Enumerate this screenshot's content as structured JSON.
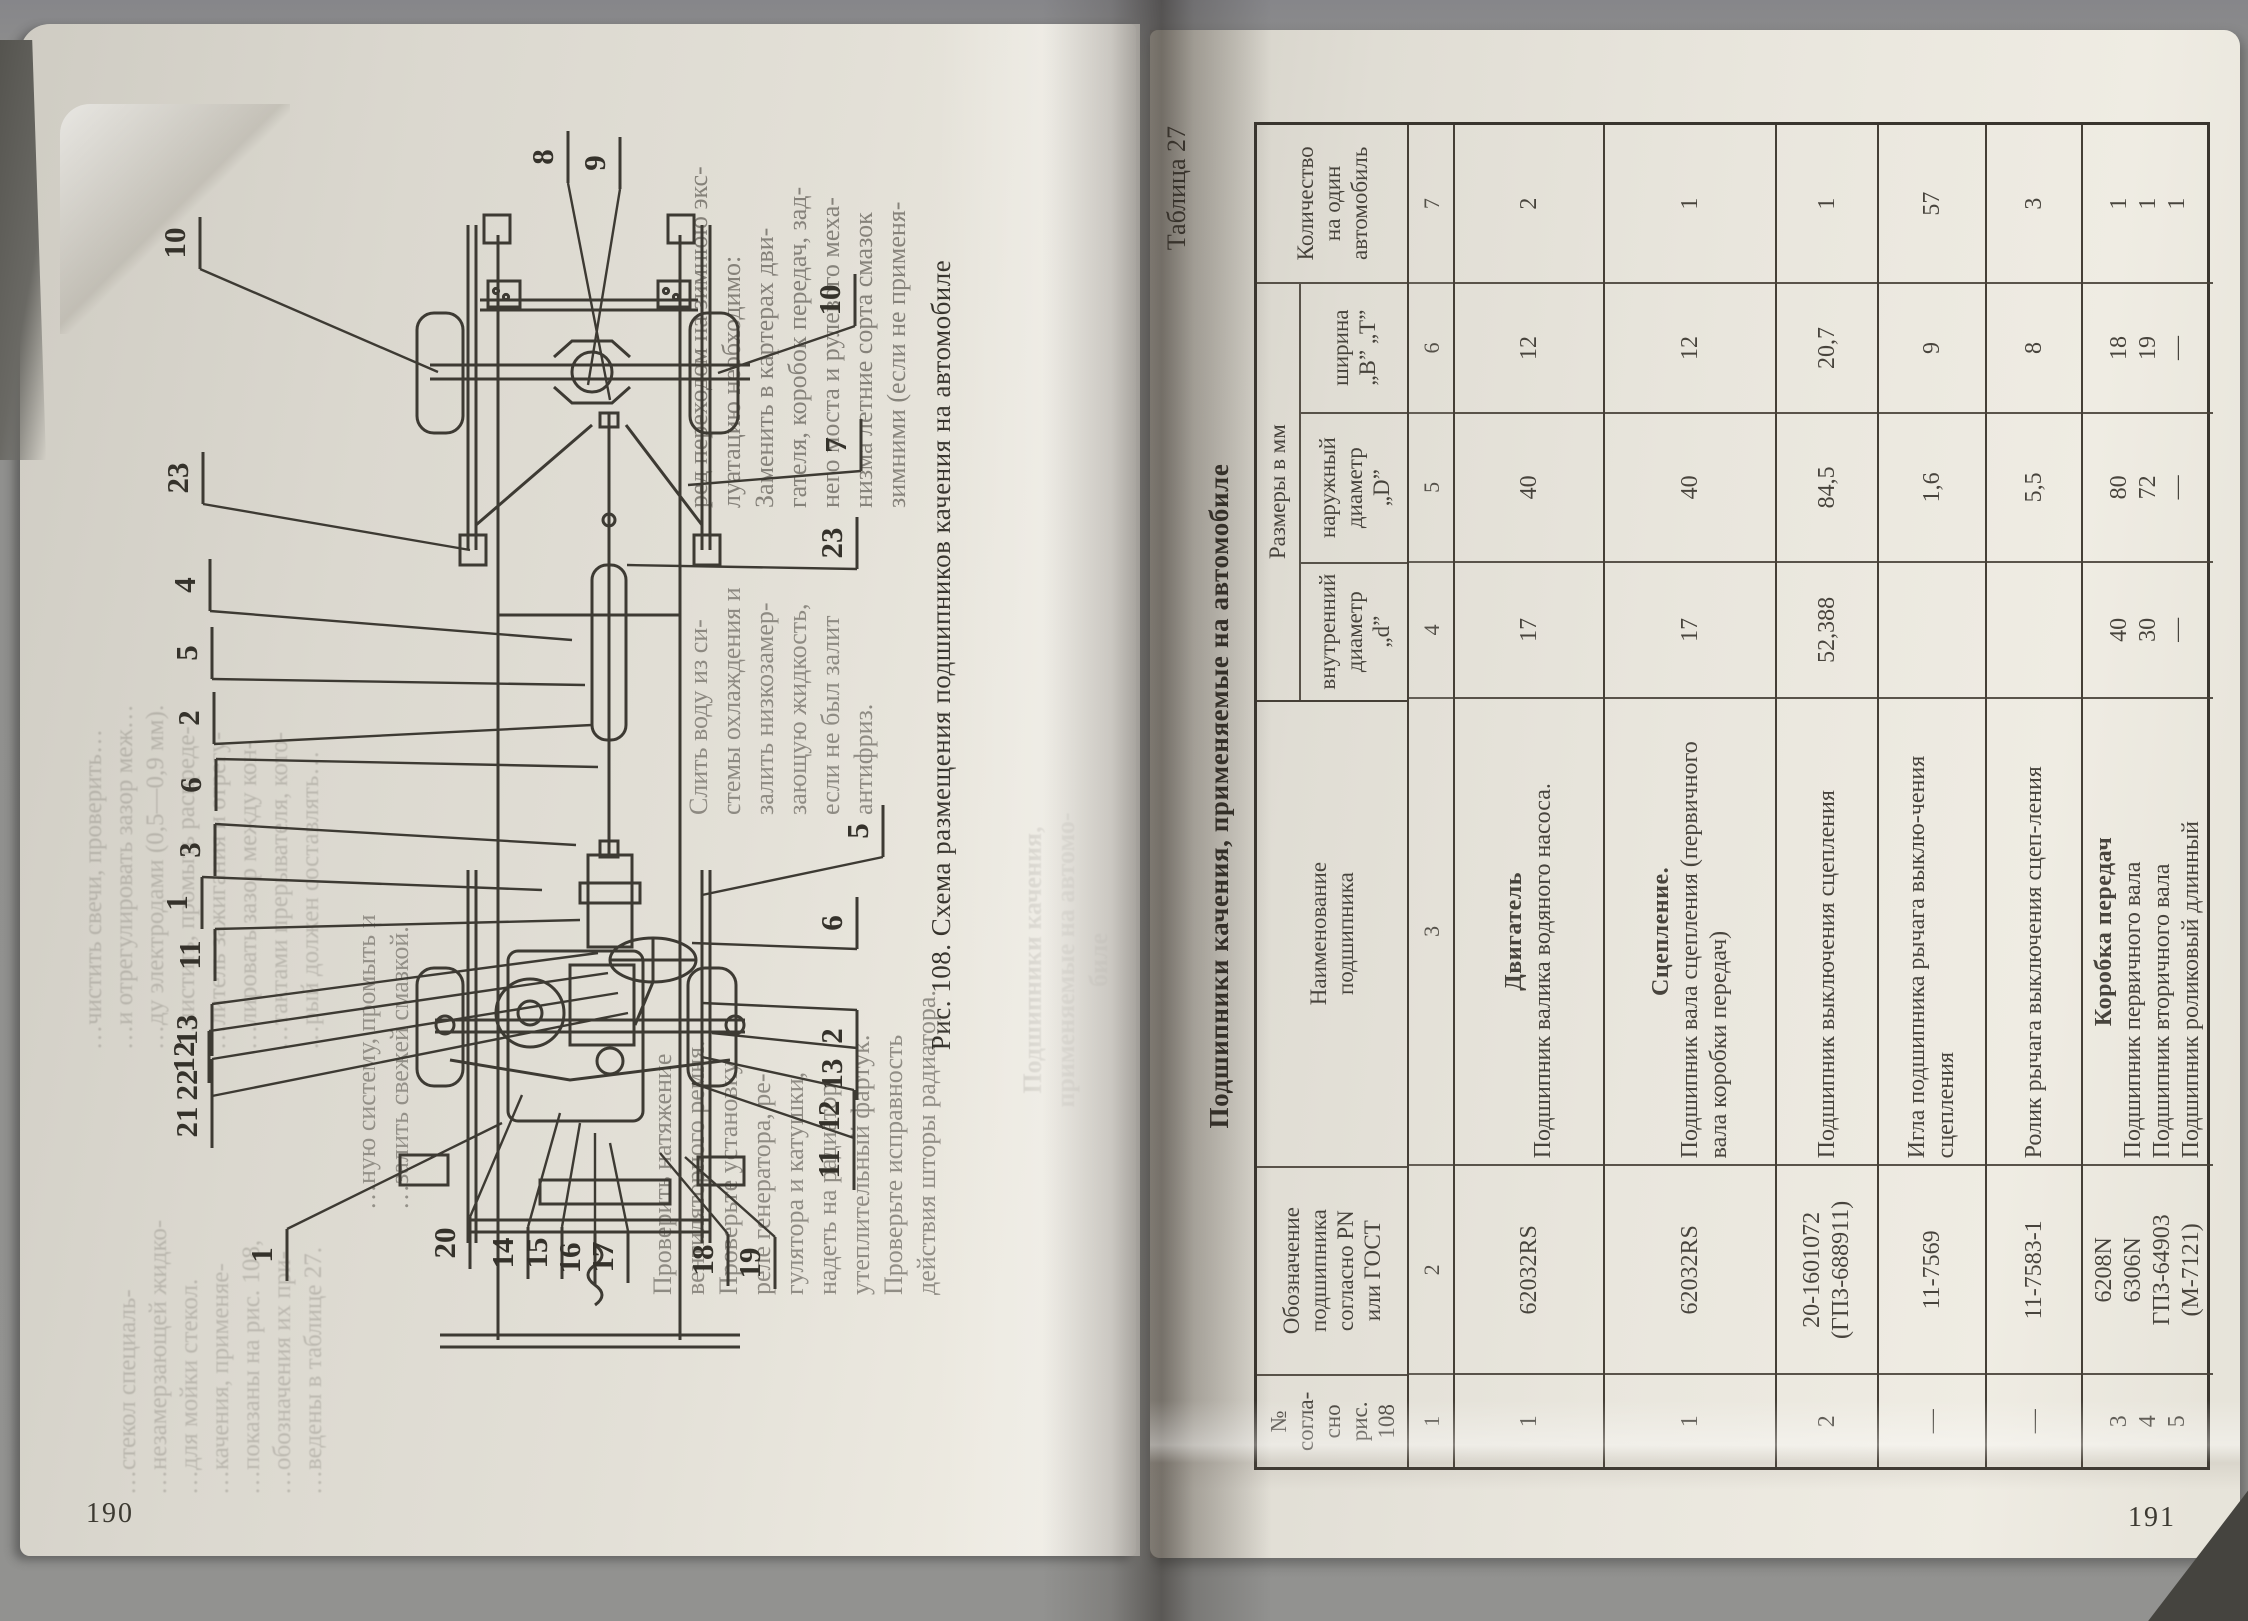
{
  "left_page": {
    "page_number": "190",
    "figure_caption": "Рис. 108. Схема размещения подшипников качения на автомобиле",
    "ghost_top_lines": [
      "…чистить свечи, проверить…",
      "…и отрегулировать зазор меж…",
      "…ду электродами (0,5—0,9 мм).",
      "…чистить, промыть распреде-",
      "…литель зажигания и отрегу-",
      "…лировать зазор между кон-",
      "…тактами прерывателя, кото-",
      "…рый должен составлять…"
    ],
    "ghost_left_lines": [
      "…стекол специаль-",
      "…незамерзающей жидко-",
      "…для мойки стекол.",
      "…качения, применяе-",
      "…показаны на рис. 108,",
      "…обозначения их при-",
      "…ведены в таблице 27."
    ],
    "col_right_lines": [
      "ред переходом на зимнюю экс-",
      "луатацию необходимо:",
      "Заменить в картерах дви-",
      "гателя, коробок передач, зад-",
      "него моста и рулевого меха-",
      "низма летние сорта смазок",
      "зимними (если не применя-"
    ],
    "col_left_lines": [
      "Слить воду из си-",
      "стемы охлаждения и",
      "залить низкозамер-",
      "зающую жидкость,",
      "если не был залит",
      "антифриз."
    ],
    "block_b_lines": [
      "…ную систему, промыть и",
      "…залить свежей смазкой."
    ],
    "block_c_lines": [
      "Проверить натяжение",
      "вентиляторного ремня.",
      "Проверьте установку",
      "реле генератора, ре-",
      "гулятора и катушки,",
      "надеть на радиатор",
      "утеплительный фартук.",
      "Проверьте исправность",
      "действия шторы радиатора."
    ],
    "heading_ghost_lines": [
      "Подшипники качения,",
      "применяемые на автомо-",
      "биле"
    ],
    "callouts": [
      {
        "n": "8",
        "x": 413,
        "y": 62,
        "tx": 470,
        "ty": 305
      },
      {
        "n": "9",
        "x": 465,
        "y": 68,
        "tx": 448,
        "ty": 290
      },
      {
        "n": "10",
        "x": 45,
        "y": 148,
        "tx": 298,
        "ty": 277
      },
      {
        "n": "10",
        "x": 700,
        "y": 205,
        "tx": 578,
        "ty": 278
      },
      {
        "n": "7",
        "x": 706,
        "y": 350,
        "tx": 548,
        "ty": 390
      },
      {
        "n": "23",
        "x": 702,
        "y": 448,
        "tx": 487,
        "ty": 470
      },
      {
        "n": "23",
        "x": 48,
        "y": 383,
        "tx": 330,
        "ty": 455
      },
      {
        "n": "4",
        "x": 55,
        "y": 490,
        "tx": 432,
        "ty": 545
      },
      {
        "n": "5",
        "x": 57,
        "y": 558,
        "tx": 445,
        "ty": 590
      },
      {
        "n": "2",
        "x": 59,
        "y": 623,
        "tx": 452,
        "ty": 630
      },
      {
        "n": "6",
        "x": 61,
        "y": 690,
        "tx": 458,
        "ty": 672
      },
      {
        "n": "3",
        "x": 60,
        "y": 755,
        "tx": 436,
        "ty": 750
      },
      {
        "n": "1",
        "x": 47,
        "y": 808,
        "tx": 402,
        "ty": 795
      },
      {
        "n": "11",
        "x": 60,
        "y": 860,
        "tx": 440,
        "ty": 825
      },
      {
        "n": "13",
        "x": 57,
        "y": 935,
        "tx": 458,
        "ty": 858
      },
      {
        "n": "12",
        "x": 54,
        "y": 962,
        "tx": 468,
        "ty": 878
      },
      {
        "n": "22",
        "x": 57,
        "y": 990,
        "tx": 478,
        "ty": 898
      },
      {
        "n": "21",
        "x": 57,
        "y": 1027,
        "tx": 488,
        "ty": 918
      },
      {
        "n": "1",
        "x": 132,
        "y": 1160,
        "tx": 362,
        "ty": 1028
      },
      {
        "n": "20",
        "x": 315,
        "y": 1148,
        "tx": 382,
        "ty": 1000
      },
      {
        "n": "14",
        "x": 373,
        "y": 1158,
        "tx": 420,
        "ty": 1018
      },
      {
        "n": "15",
        "x": 407,
        "y": 1158,
        "tx": 440,
        "ty": 1028
      },
      {
        "n": "16",
        "x": 440,
        "y": 1163,
        "tx": 455,
        "ty": 1038
      },
      {
        "n": "17",
        "x": 473,
        "y": 1162,
        "tx": 470,
        "ty": 1048
      },
      {
        "n": "18",
        "x": 573,
        "y": 1165,
        "tx": 520,
        "ty": 1058
      },
      {
        "n": "19",
        "x": 620,
        "y": 1168,
        "tx": 545,
        "ty": 1062
      },
      {
        "n": "5",
        "x": 728,
        "y": 736,
        "tx": 562,
        "ty": 800
      },
      {
        "n": "6",
        "x": 702,
        "y": 828,
        "tx": 552,
        "ty": 848
      },
      {
        "n": "2",
        "x": 702,
        "y": 941,
        "tx": 562,
        "ty": 908
      },
      {
        "n": "13",
        "x": 702,
        "y": 979,
        "tx": 572,
        "ty": 938
      },
      {
        "n": "12",
        "x": 699,
        "y": 1021,
        "tx": 562,
        "ty": 962
      },
      {
        "n": "11",
        "x": 699,
        "y": 1069,
        "tx": 552,
        "ty": 988
      }
    ]
  },
  "right_page": {
    "page_number": "191",
    "table_label": "Таблица 27",
    "table_title": "Подшипники качения, применяемые на автомобиле",
    "table": {
      "headers": {
        "num": "№ согла-\nсно\nрис. 108",
        "designation": "Обозначение\nподшипника\nсогласно PN\nили ГОСТ",
        "name": "Наименование\nподшипника",
        "sizes": "Размеры в мм",
        "d": "внутренний\nдиаметр\n„d”",
        "D": "наружный\nдиаметр\n„D”",
        "B": "ширина\n„B”  „T”",
        "qty": "Количество\nна один\nавтомобиль"
      },
      "col_numbers": [
        "1",
        "2",
        "3",
        "4",
        "5",
        "6",
        "7"
      ],
      "rows": [
        {
          "num": "1",
          "designation": "62032RS",
          "section": "Двигатель",
          "name": "Подшипник валика водяного насоса.",
          "d": "17",
          "D": "40",
          "B": "12",
          "qty": "2"
        },
        {
          "num": "1",
          "designation": "62032RS",
          "section": "Сцепление.",
          "name": "Подшипник вала сцепления (первичного вала коробки передач)",
          "d": "17",
          "D": "40",
          "B": "12",
          "qty": "1"
        },
        {
          "num": "2",
          "designation": "20-1601072\n(ГПЗ-688911)",
          "section": "",
          "name": "Подшипник выключения сцепления",
          "d": "52,388",
          "D": "84,5",
          "B": "20,7",
          "qty": "1"
        },
        {
          "num": "—",
          "designation": "11-7569",
          "section": "",
          "name": "Игла подшипника рычага выклю-чения сцепления",
          "d": "",
          "D": "1,6",
          "B": "9",
          "qty": "57"
        },
        {
          "num": "—",
          "designation": "11-7583-1",
          "section": "",
          "name": "Ролик рычага выключения сцеп-ления",
          "d": "",
          "D": "5,5",
          "B": "8",
          "qty": "3"
        },
        {
          "num": "3\n4\n5",
          "designation": "6208N\n6306N\nГПЗ-64903\n(М-7121)",
          "section": "Коробка передач",
          "name": "Подшипник первичного вала\nПодшипник вторичного вала\nПодшипник роликовый длинный",
          "d": "40\n30\n—",
          "D": "80\n72\n—",
          "B": "18\n19\n—",
          "qty": "1\n1\n1"
        }
      ]
    }
  }
}
